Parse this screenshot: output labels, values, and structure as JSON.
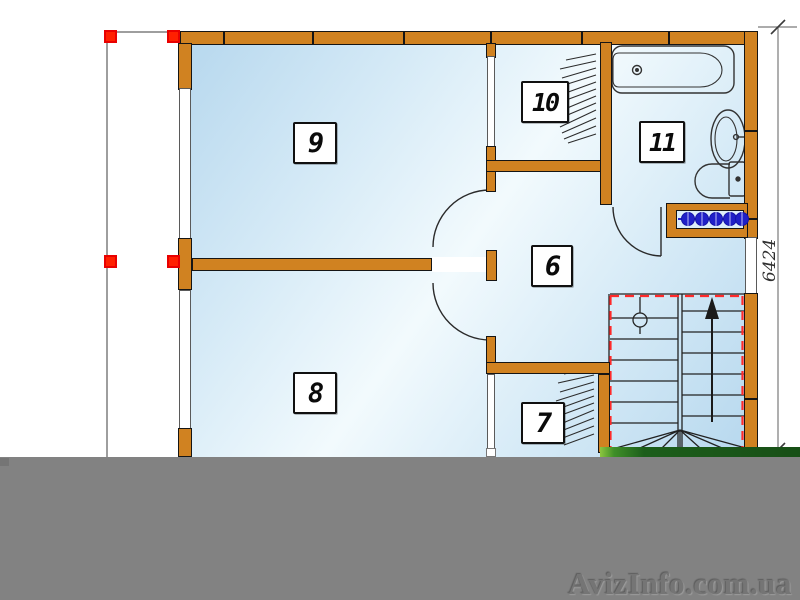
{
  "drawing": {
    "type": "architectural floor plan, upper storey",
    "watermark_text": "AvizInfo.com.ua",
    "dimension_right_mm": "6424"
  },
  "room_labels": {
    "r6": "6",
    "r7": "7",
    "r8": "8",
    "r9": "9",
    "r10": "10",
    "r11": "11"
  },
  "fixtures": [
    {
      "name": "bathtub"
    },
    {
      "name": "washbasin"
    },
    {
      "name": "toilet"
    },
    {
      "name": "towel-radiator"
    },
    {
      "name": "staircase-up-arrow"
    },
    {
      "name": "wardrobe-hatch-room10"
    },
    {
      "name": "wardrobe-hatch-room7"
    }
  ],
  "colors": {
    "wall_orange": "#d08221",
    "outline_black": "#151515",
    "room_blue_light": "#f2fafd",
    "room_blue_dark": "#b7d8ee",
    "marker_red": "#ff2000",
    "stair_dash_red": "#ff2a2a",
    "radiator_blue": "#2222cc",
    "grass_green": "#1c5e1a",
    "censor_gray": "#828282"
  }
}
